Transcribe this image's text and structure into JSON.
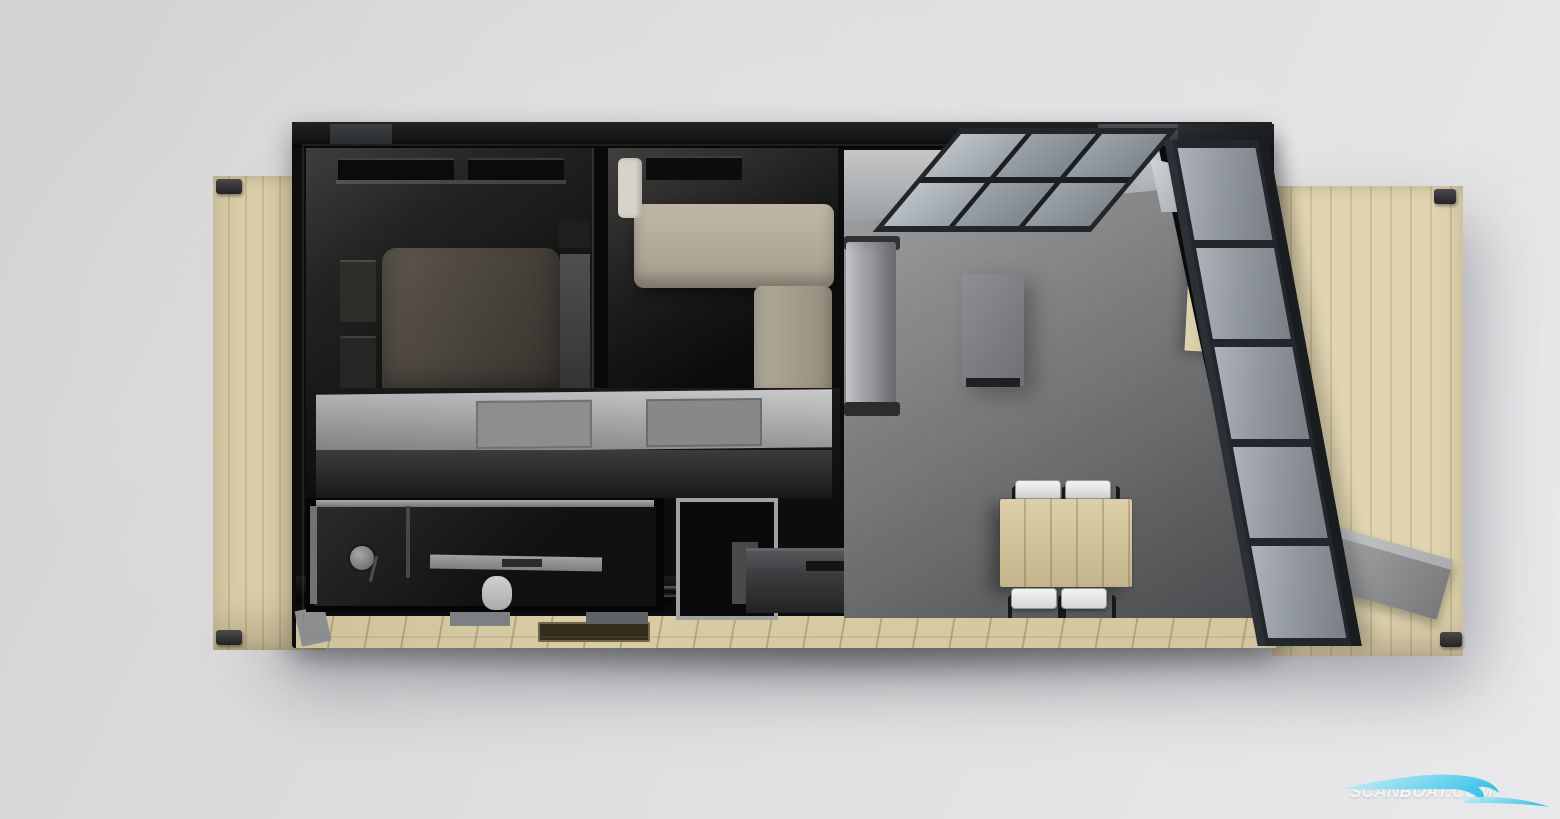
{
  "watermark": {
    "text": "SCANBOAT.COM",
    "text_color": "#fafcfd",
    "wave_color_light": "#d6f3fb",
    "wave_color_deep": "#2ec1ea"
  },
  "palette": {
    "background": "#dedfe1",
    "deck_wood": "#d9cda8",
    "deck_plank_line": "#c6b78e",
    "hull_frame": "#0d0d0c",
    "living_floor": "#717375",
    "bedroom_floor": "#1c1c1a",
    "double_bed": "#4a453e",
    "single_bed_mattress": "#b2aa9a",
    "sofa": "#9c9ea1",
    "wood_furniture": "#cdbf98",
    "chair_seat": "#e9e9e7",
    "glass": "#8f969c",
    "gangway": "#8f9193"
  },
  "floorplan": {
    "view": "top-down 3d render",
    "decks": [
      {
        "name": "port-deck-left",
        "material": "wood"
      },
      {
        "name": "starboard-deck-right",
        "material": "wood"
      }
    ],
    "rooms": [
      {
        "name": "master-bedroom",
        "furniture": [
          "double-bed",
          "nightstand",
          "nightstand",
          "window"
        ]
      },
      {
        "name": "second-bedroom",
        "furniture": [
          "single-bed",
          "pillow",
          "corner-bench",
          "window"
        ]
      },
      {
        "name": "corridor",
        "furniture": [
          "wardrobe"
        ]
      },
      {
        "name": "bathroom",
        "furniture": [
          "shower-head",
          "shower-glass",
          "vanity",
          "toilet"
        ]
      },
      {
        "name": "closet",
        "furniture": []
      },
      {
        "name": "living-area",
        "furniture": [
          "sofa",
          "coffee-table",
          "sideboard",
          "dining-table",
          "dining-chair",
          "dining-chair",
          "dining-chair",
          "dining-chair",
          "kitchen-counter"
        ]
      }
    ],
    "exterior_features": [
      "skylight-glass-roof",
      "window-wall",
      "gangway",
      "boarding-step",
      "walkway-step",
      "deck-brackets"
    ]
  }
}
